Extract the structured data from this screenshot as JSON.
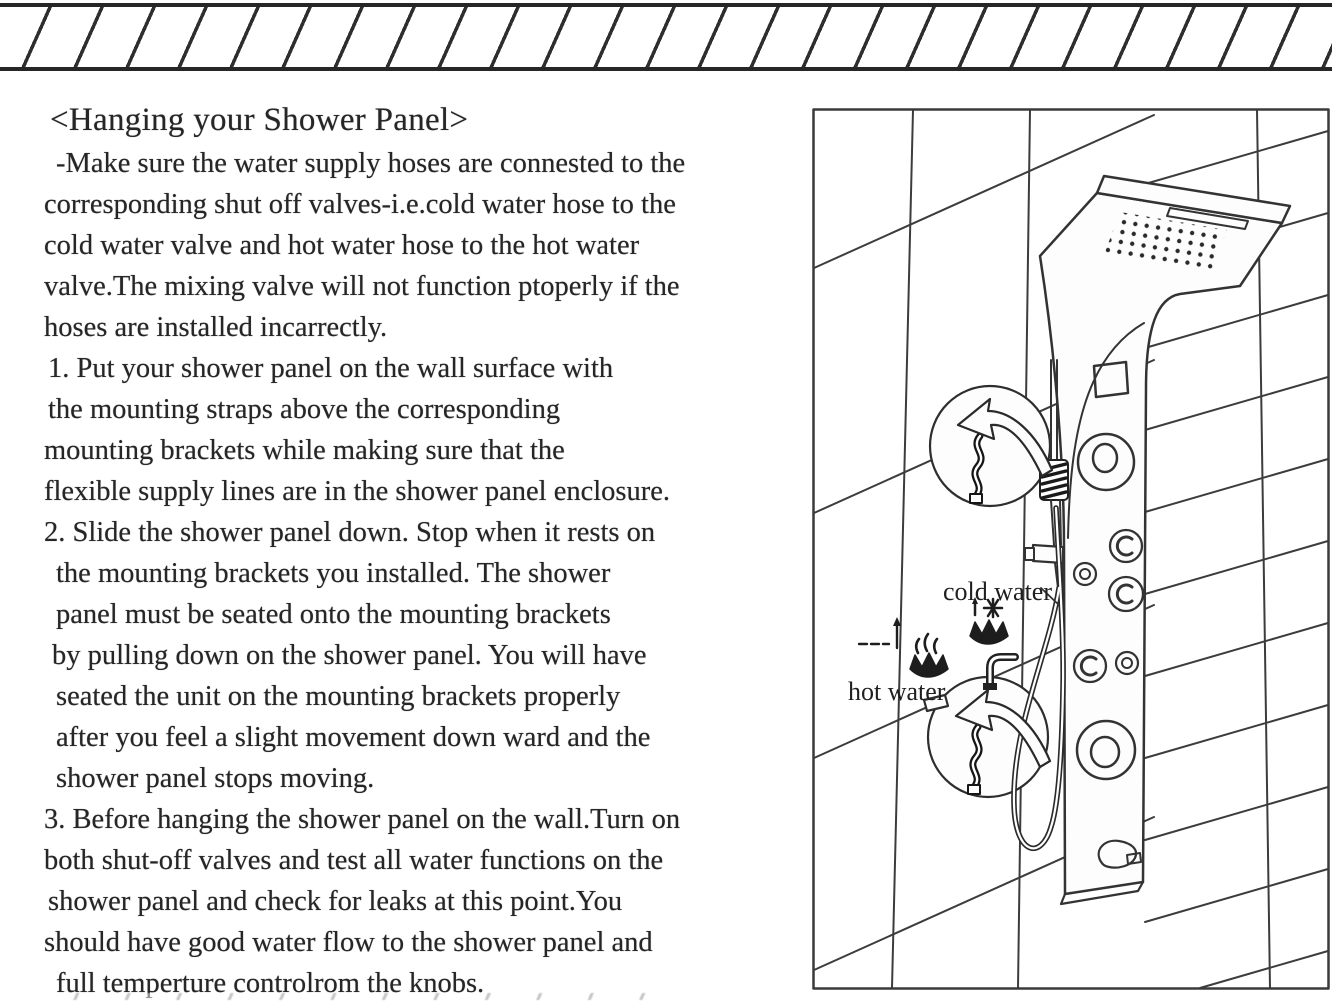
{
  "instructions": {
    "title": "<Hanging your Shower Panel>",
    "lines": [
      "-Make sure the water supply hoses are connested to the",
      "corresponding shut off valves-i.e.cold water hose to the",
      "cold water valve and hot water hose to the hot water",
      "valve.The mixing valve will not function ptoperly if the",
      "hoses are installed incarrectly.",
      "1. Put your shower panel on the wall surface with",
      "the mounting straps above the corresponding",
      "mounting brackets while making sure that the",
      "flexible supply lines are in the shower panel enclosure.",
      "2. Slide the shower panel down. Stop when it rests on",
      "the mounting brackets you installed. The shower",
      "panel must be seated onto the mounting brackets",
      "by pulling down on the shower panel. You will have",
      "seated the unit on the mounting brackets properly",
      "after you feel a slight movement down ward and the",
      "shower panel stops moving.",
      "3. Before hanging the shower panel on the wall.Turn on",
      "both shut-off valves and test all water functions on the",
      "shower panel and check for leaks at this point.You",
      "should have good water flow to the shower panel and",
      "full temperture controlrom the knobs."
    ]
  },
  "diagram": {
    "cold_water_label": "cold water",
    "hot_water_label": "hot water",
    "icons": {
      "cold": "water-splash-snowflake-icon",
      "hot": "water-splash-flame-icon",
      "inset": "mounting-bracket-with-curved-arrow",
      "decor": "hatched-divider"
    },
    "colors": {
      "ink": "#262626",
      "line": "#333333"
    }
  }
}
